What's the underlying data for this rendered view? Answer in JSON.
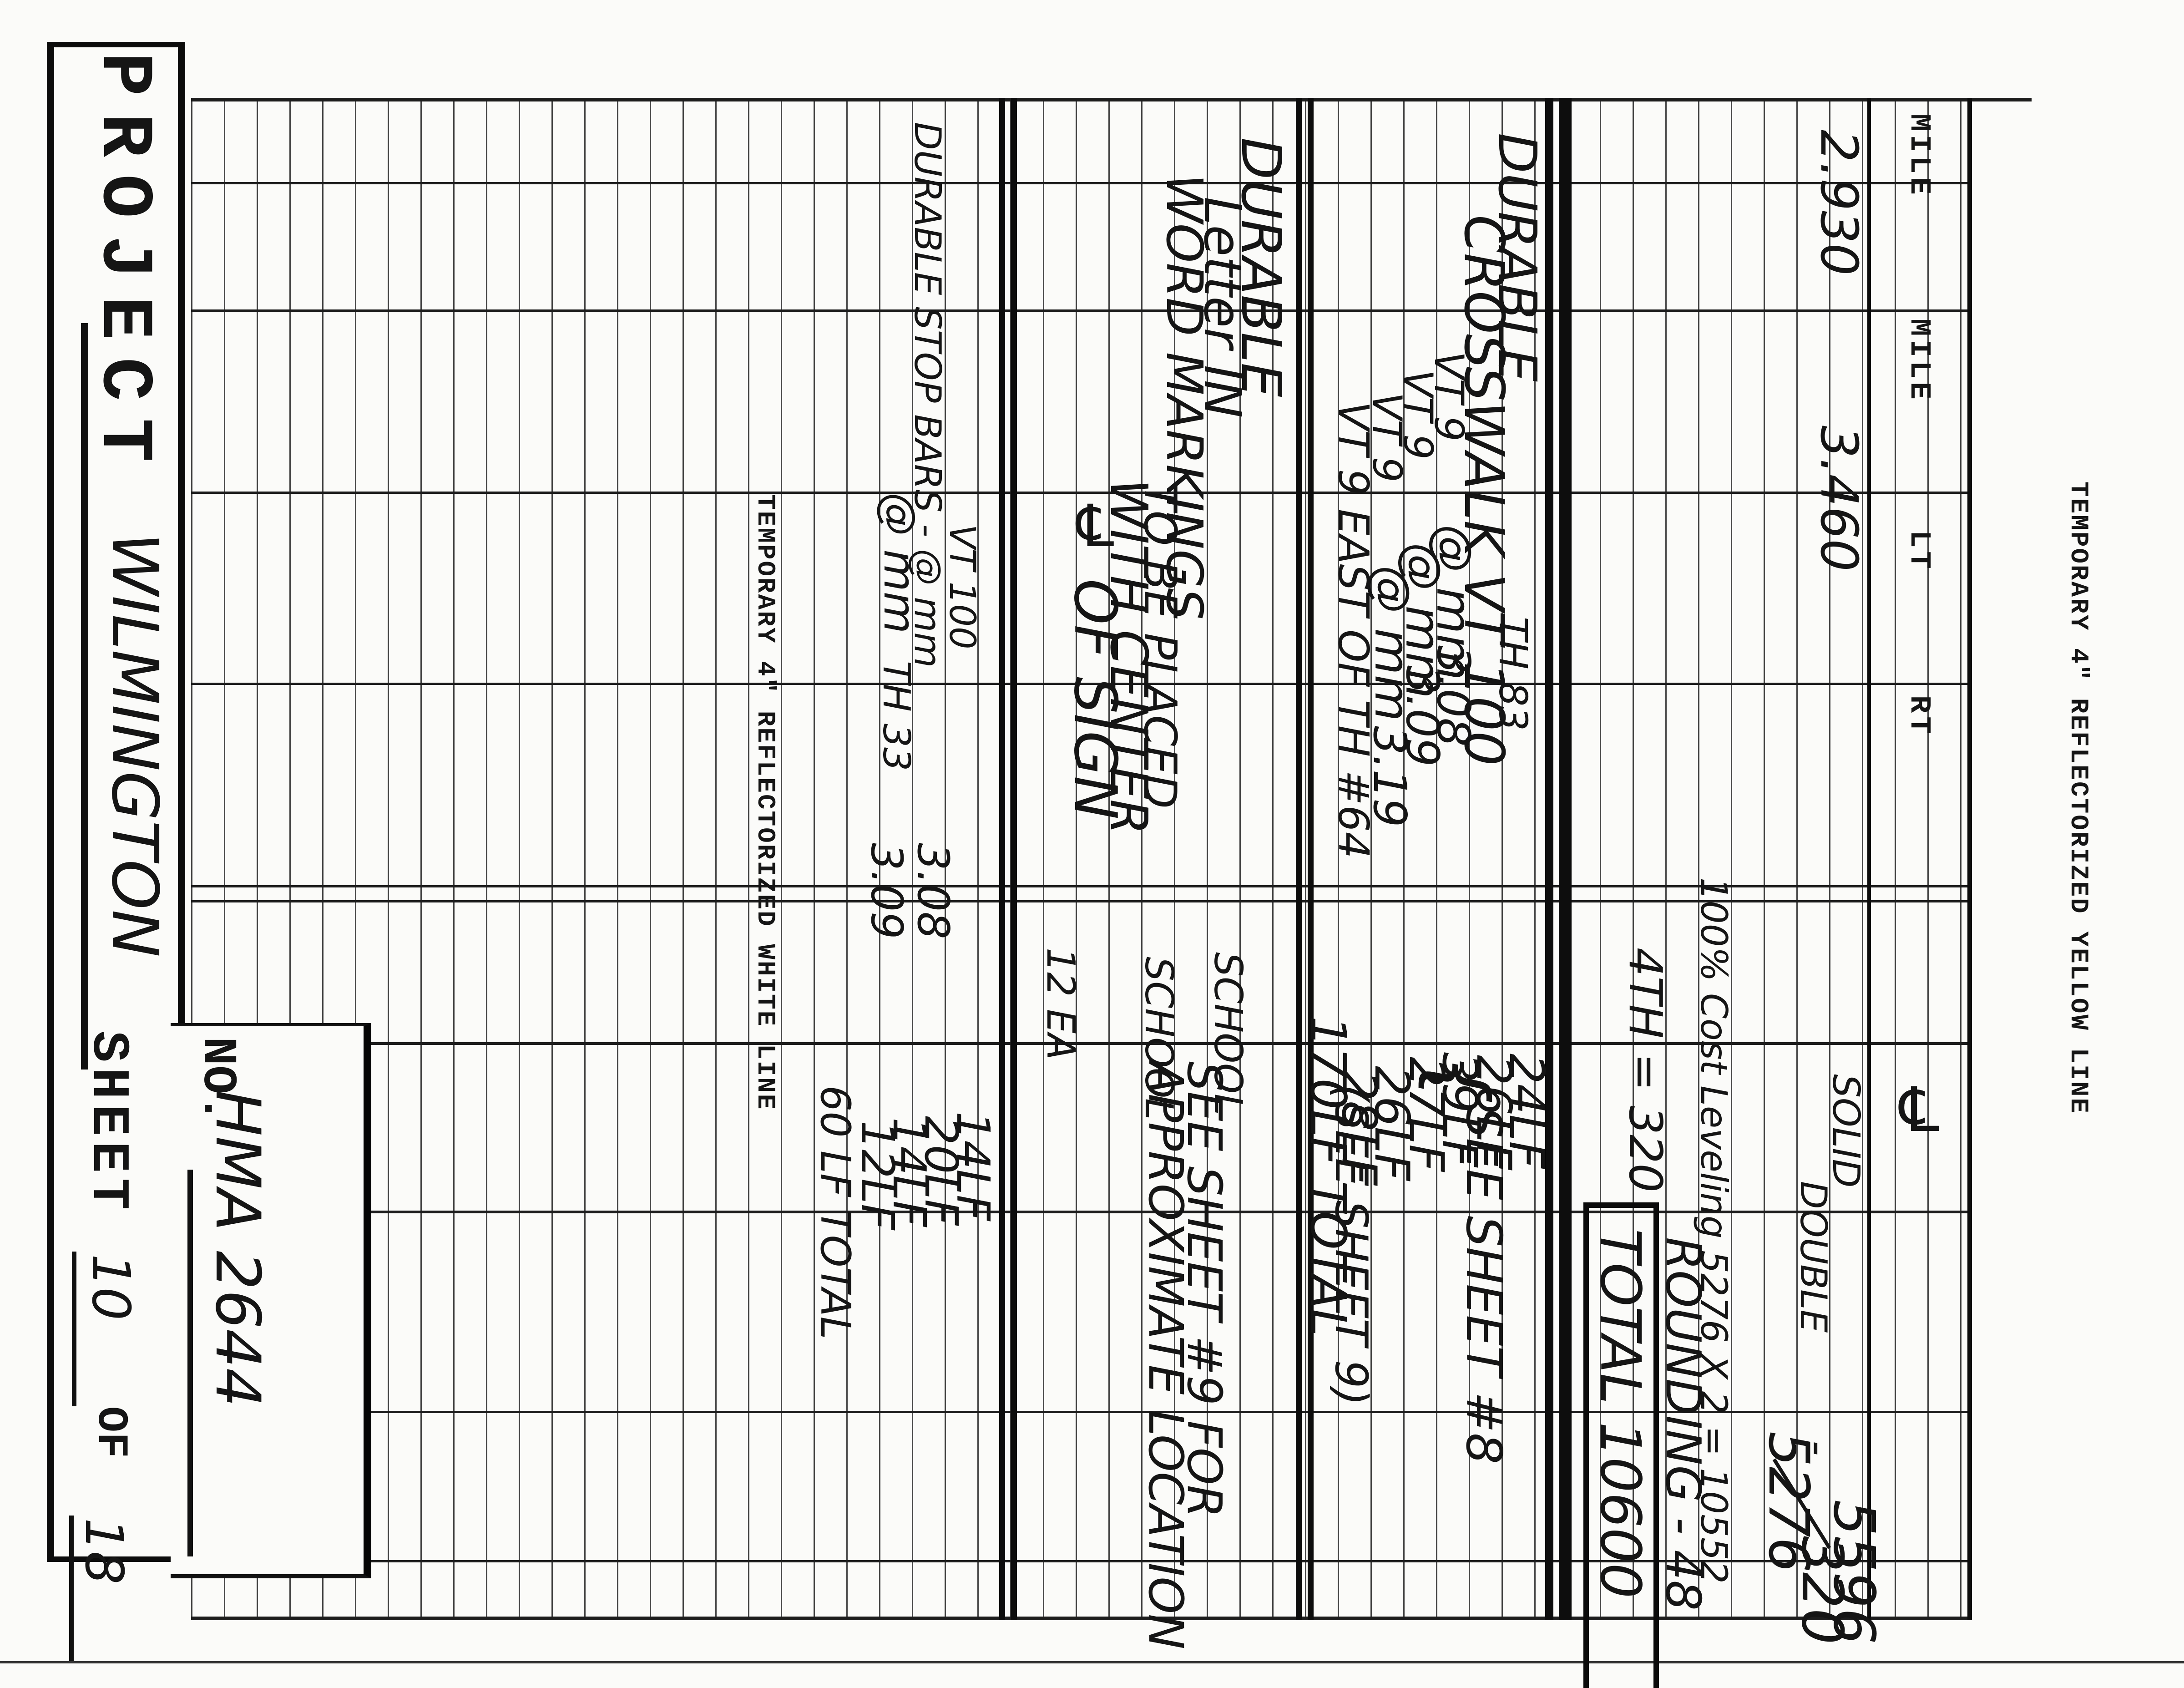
{
  "scan": {
    "right_margin_title": "TEMPORARY 4\" REFLECTORIZED YELLOW LINE",
    "center_title": "TEMPORARY 4\" REFLECTORIZED WHITE LINE"
  },
  "title_block": {
    "project_label": "PROJECT",
    "project_value": "WILMINGTON",
    "no_label": "NO.",
    "no_value": "HMA 2644",
    "sheet_label": "SHEET",
    "sheet_number": "10",
    "of_label": "OF",
    "total_sheets": "18"
  },
  "table": {
    "col_headers": [
      "MILE",
      "MILE",
      "LT",
      "RT"
    ],
    "centerline_symbol": "℄",
    "mile_begin": "2.930",
    "mile_end": "3.460"
  },
  "yellow_line": {
    "solid_label": "SOLID",
    "double_label": "DOUBLE",
    "solid_qty": "5596",
    "double_qty": "320",
    "minus_mark": "-",
    "difference": "5276",
    "leveling_note": "100% Cost Leveling 5276 X 2 = 10552",
    "rounding_note": "ROUNDING - 48",
    "grand_total": "TOTAL 10600",
    "fourth_st_note": "4TH = 320"
  },
  "crosswalks": {
    "line1": "DURABLE",
    "line2": "CROSSWALK VT 100",
    "line1_loc": "TH 83",
    "qty1": "24LF",
    "qty2": "26LF",
    "rows": [
      {
        "a": "VT 9",
        "b": "@ mm",
        "mm": "3.08",
        "qty": "39LF"
      },
      {
        "a": "VT 9",
        "b": "@ mm",
        "mm": "3.09",
        "qty": "27LF"
      },
      {
        "a": "VT 9",
        "b": "@ mm",
        "mm": "3.19",
        "qty": "26LF"
      }
    ],
    "east_row": {
      "a": "VT 9 EAST OF TH #64",
      "qty": "28LF"
    },
    "total": "170LF TOTAL",
    "brace": "{",
    "see_sheet_8": "SEE SHEET #8",
    "see_sheet_9": "(SEE SHEET 9)"
  },
  "word_markings": {
    "line1": "DURABLE",
    "line2": "Letter IN",
    "line3": "WORD MARKINGS",
    "line4": "TO BE PLACED",
    "line5": "WITH CENTER",
    "line6": "℄ OF SIGN",
    "school_a": "SCHOOL",
    "school_b": "SCHOOL",
    "qty": "12 EA",
    "note_line1": "SEE SHEET #9 FOR",
    "note_line2": "APPROXIMATE LOCATION"
  },
  "stop_bars": {
    "loc": "VT 100",
    "line1": "DURABLE STOP BARS - @ mm",
    "line2": "@ mm",
    "line3": "TH 33",
    "mm1": "3.08",
    "mm2": "3.09",
    "qty1": "14LF",
    "qty2": "20LF",
    "qty3": "14LF",
    "qty4": "12LF",
    "total": "60 LF TOTAL"
  }
}
